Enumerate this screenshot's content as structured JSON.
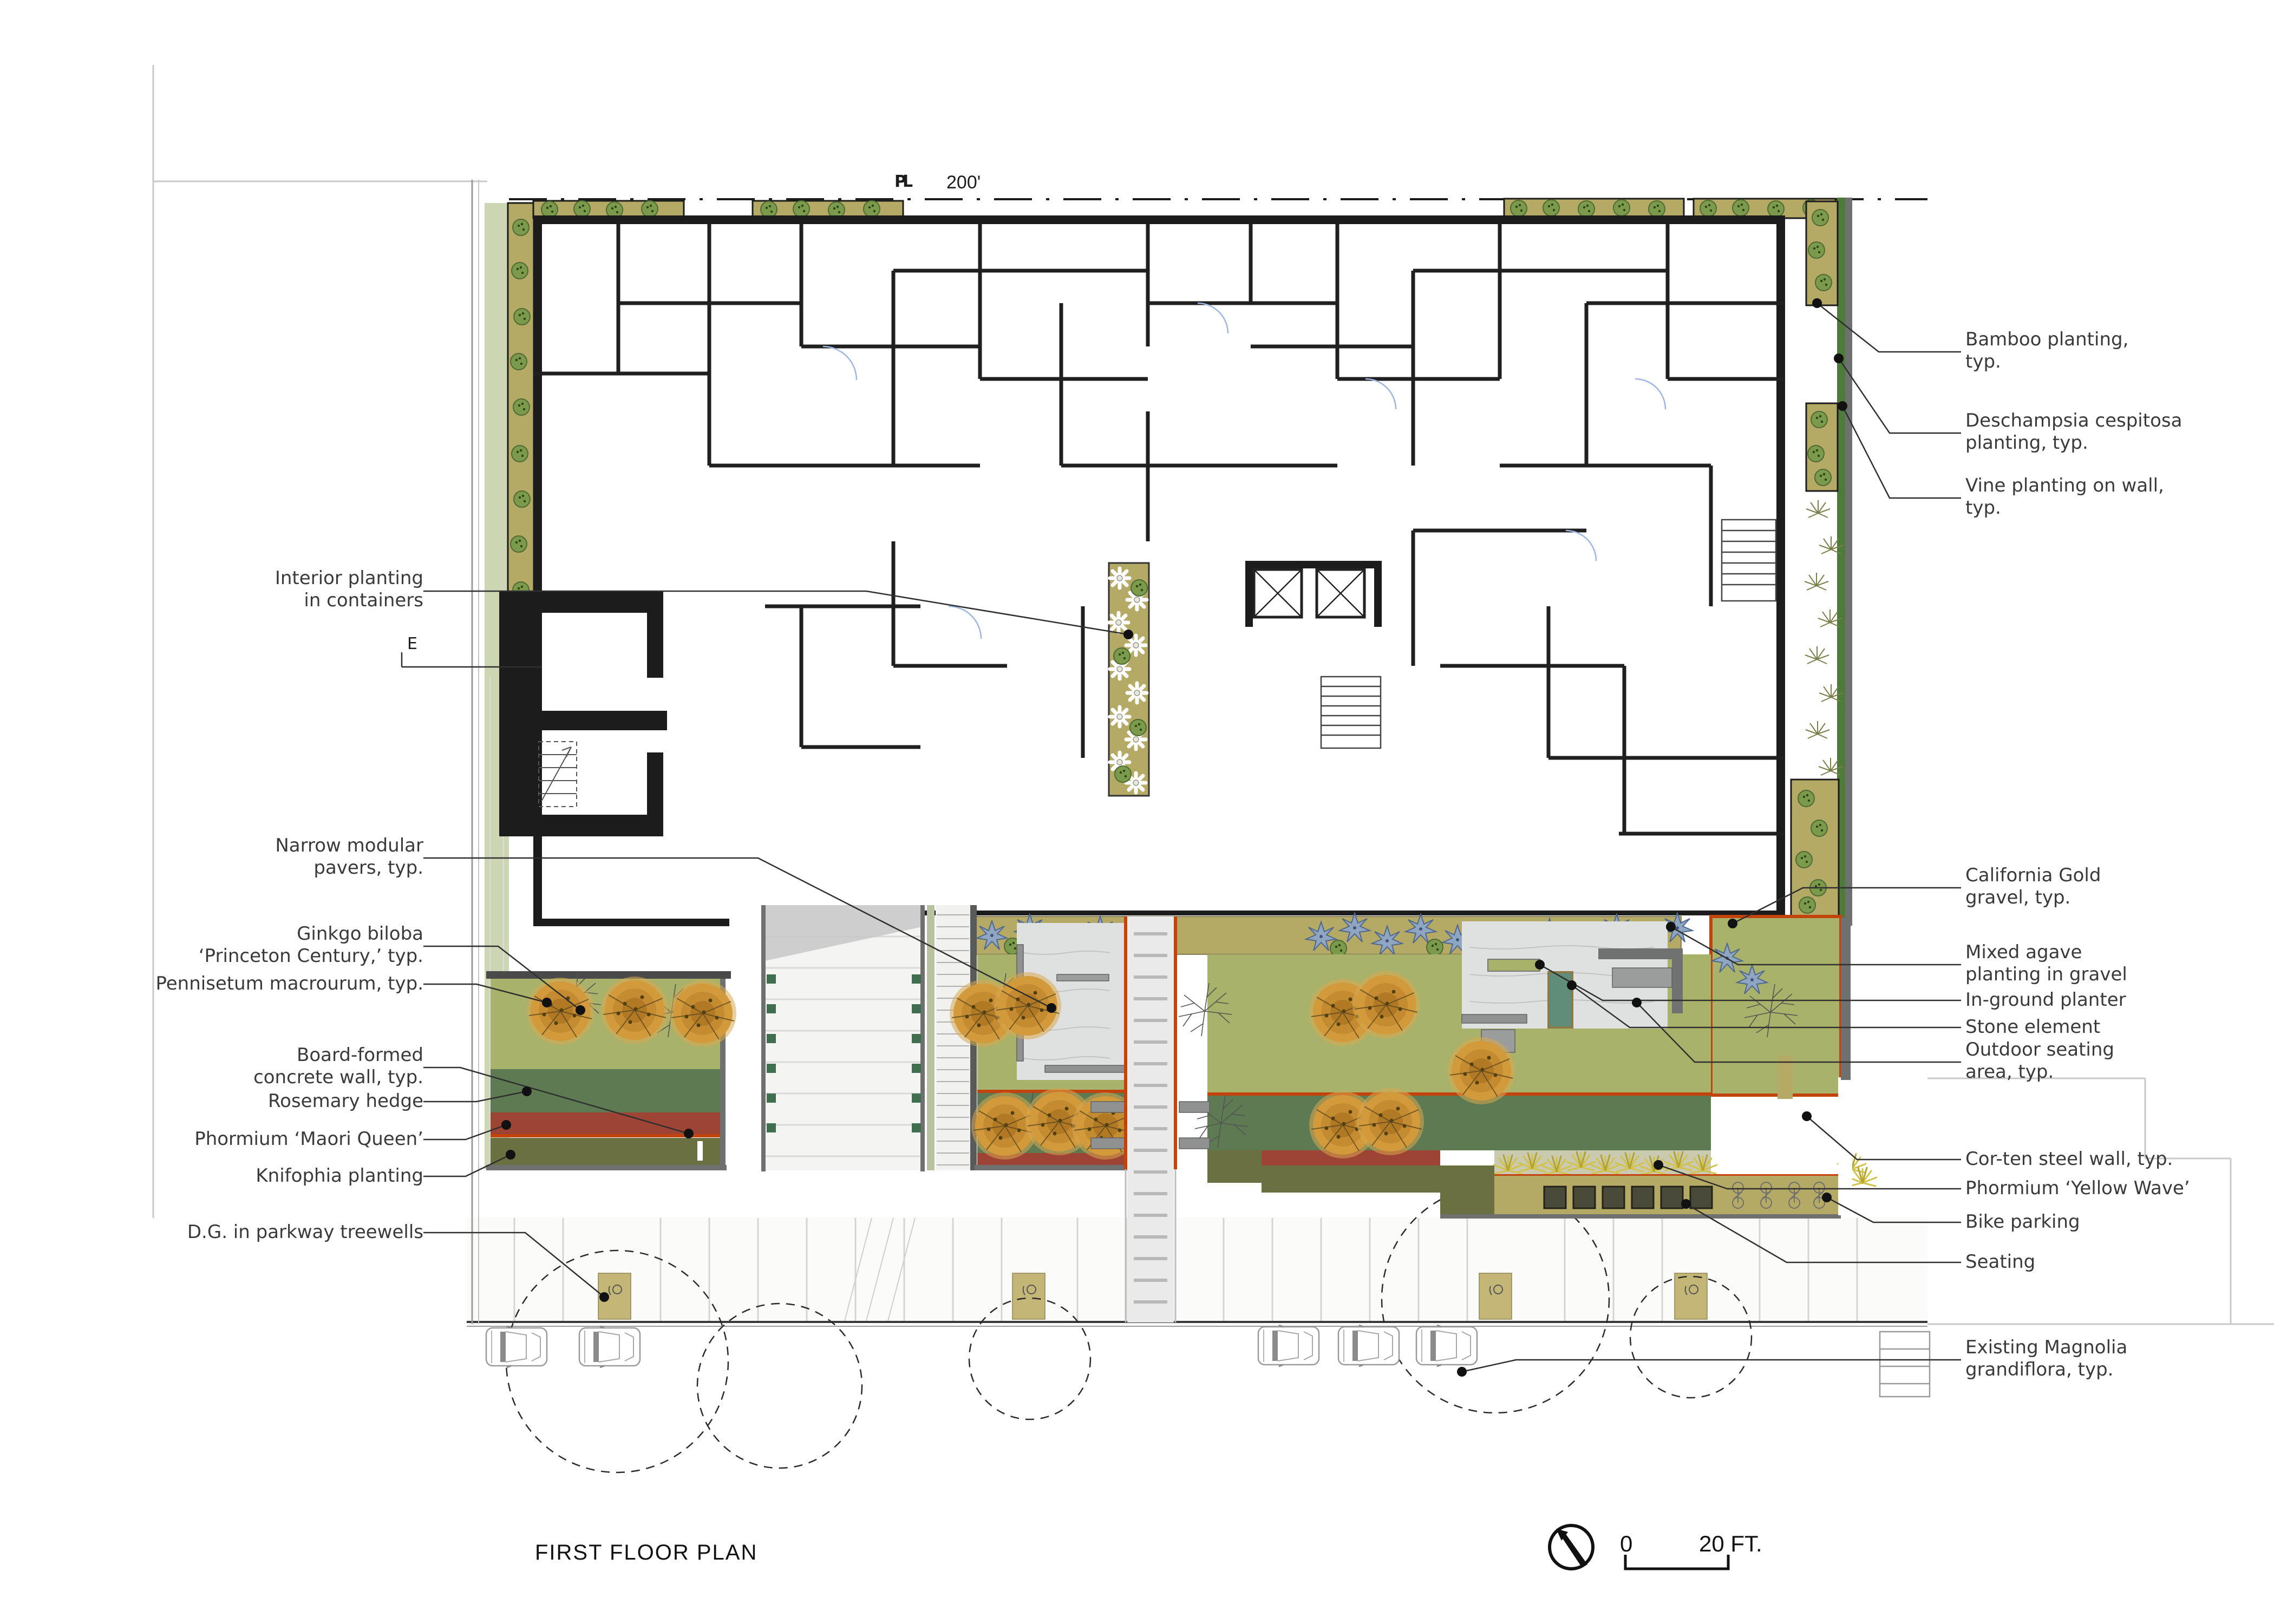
{
  "title": "FIRST FLOOR PLAN",
  "scale_bar": {
    "zero": "0",
    "end_label": "20 FT."
  },
  "plan_marks": {
    "property_line_mark": "PL",
    "property_line_dimension": "200'",
    "east_mark": "E"
  },
  "annotations": {
    "left": [
      {
        "text": "Interior planting\nin containers"
      },
      {
        "text": "Narrow modular\npavers, typ."
      },
      {
        "text": "Ginkgo biloba\n‘Princeton Century,’ typ."
      },
      {
        "text": "Pennisetum macrourum, typ."
      },
      {
        "text": "Board-formed\nconcrete wall, typ."
      },
      {
        "text": "Rosemary hedge"
      },
      {
        "text": "Phormium ‘Maori Queen’"
      },
      {
        "text": "Knifophia planting"
      },
      {
        "text": "D.G. in parkway treewells"
      }
    ],
    "right": [
      {
        "text": "Bamboo planting,\ntyp."
      },
      {
        "text": "Deschampsia cespitosa\nplanting, typ."
      },
      {
        "text": "Vine planting on wall,\ntyp."
      },
      {
        "text": "California Gold\ngravel, typ."
      },
      {
        "text": "Mixed agave\nplanting in gravel"
      },
      {
        "text": "In-ground planter"
      },
      {
        "text": "Stone element"
      },
      {
        "text": "Outdoor seating\narea, typ."
      },
      {
        "text": "Cor-ten steel wall, typ."
      },
      {
        "text": "Phormium ‘Yellow Wave’"
      },
      {
        "text": "Bike parking"
      },
      {
        "text": "Seating"
      },
      {
        "text": "Existing Magnolia\ngrandiflora, typ."
      }
    ]
  },
  "palette": {
    "corten_steel": "#c2440c",
    "meadow_grass": "#a9b26a",
    "rosemary_hedge": "#5d7a52",
    "california_gold_gravel": "#b5a966",
    "phormium_red": "#9e4434",
    "knifophia_yellow": "#e3b52d",
    "agave_blue": "#8fa6c2",
    "ginkgo_orange": "#d29a3a",
    "paver_gray": "#dfe1e0",
    "wall_black": "#1c1c1c"
  }
}
